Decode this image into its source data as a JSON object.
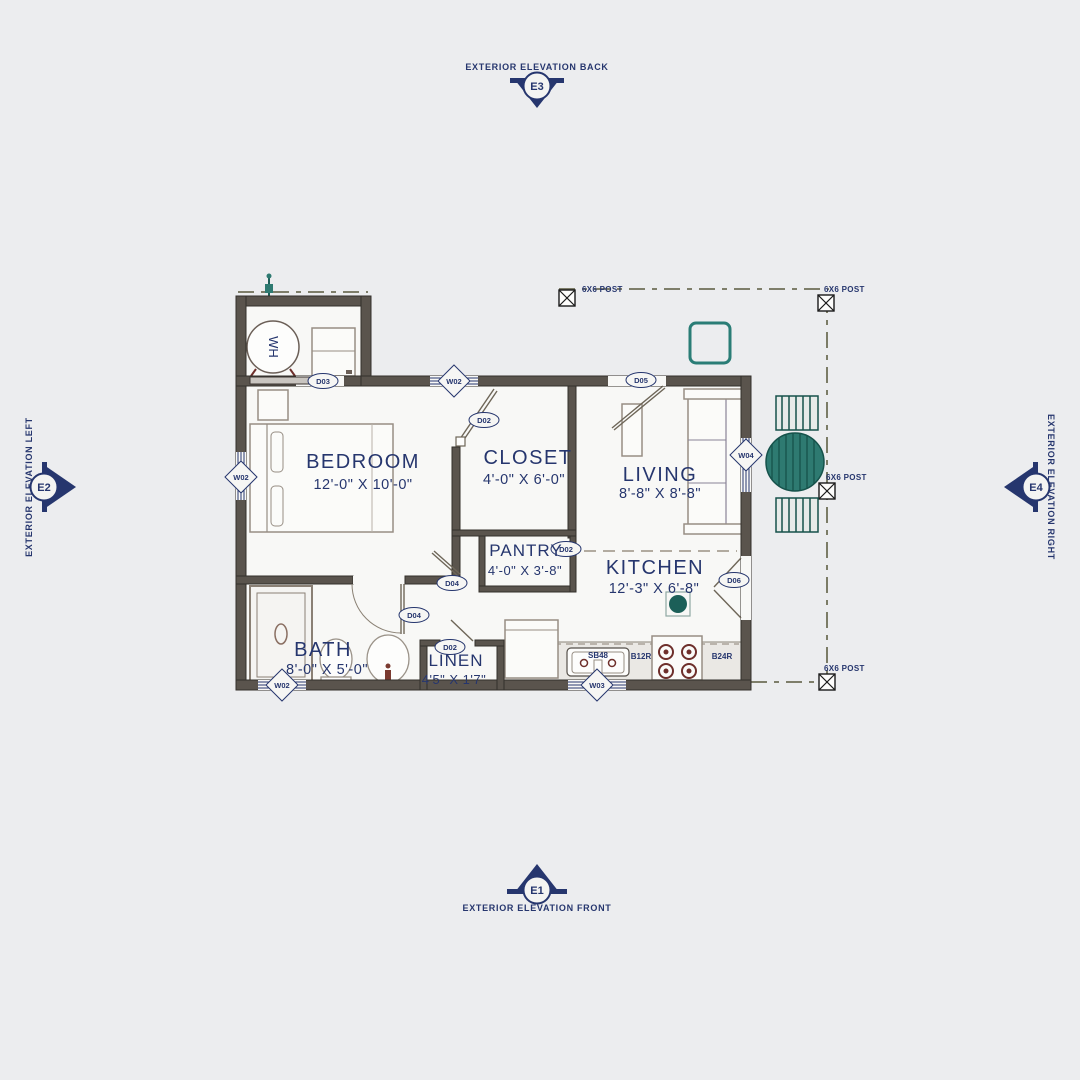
{
  "colors": {
    "ink": "#26366e",
    "wall": "#5a544d",
    "teal": "#2e7a71",
    "teal_dark": "#16524b",
    "burner": "#6e2f2b",
    "background": "#ecedef"
  },
  "elevations": {
    "back": {
      "code": "E3",
      "label": "EXTERIOR ELEVATION BACK"
    },
    "left": {
      "code": "E2",
      "label": "EXTERIOR ELEVATION LEFT"
    },
    "right": {
      "code": "E4",
      "label": "EXTERIOR ELEVATION RIGHT"
    },
    "front": {
      "code": "E1",
      "label": "EXTERIOR ELEVATION FRONT"
    }
  },
  "rooms": {
    "bedroom": {
      "name": "BEDROOM",
      "dims": "12'-0\" X 10'-0\""
    },
    "closet": {
      "name": "CLOSET",
      "dims": "4'-0\" X 6'-0\""
    },
    "living": {
      "name": "LIVING",
      "dims": "8'-8\" X 8'-8\""
    },
    "pantry": {
      "name": "PANTRY",
      "dims": "4'-0\" X 3'-8\""
    },
    "kitchen": {
      "name": "KITCHEN",
      "dims": "12'-3\" X 6'-8\""
    },
    "bath": {
      "name": "BATH",
      "dims": "8'-0\" X 5'-0\""
    },
    "linen": {
      "name": "LINEN",
      "dims": "4'5\" X 1'7\""
    }
  },
  "door_tags": {
    "utility": "D03",
    "closet": "D02",
    "pantry": "D02",
    "entry": "D05",
    "bedroom": "D04",
    "bath": "D04",
    "linen": "D02",
    "kitchen_double": "D06"
  },
  "window_tags": {
    "top": "W02",
    "left": "W02",
    "bottom_left": "W02",
    "bottom_center": "W03",
    "right": "W04"
  },
  "fixtures": {
    "water_heater": "WH",
    "sink_base": "SB48",
    "base_cabinet_12": "B12R",
    "base_cabinet_24": "B24R"
  },
  "post_label": "6X6 POST"
}
